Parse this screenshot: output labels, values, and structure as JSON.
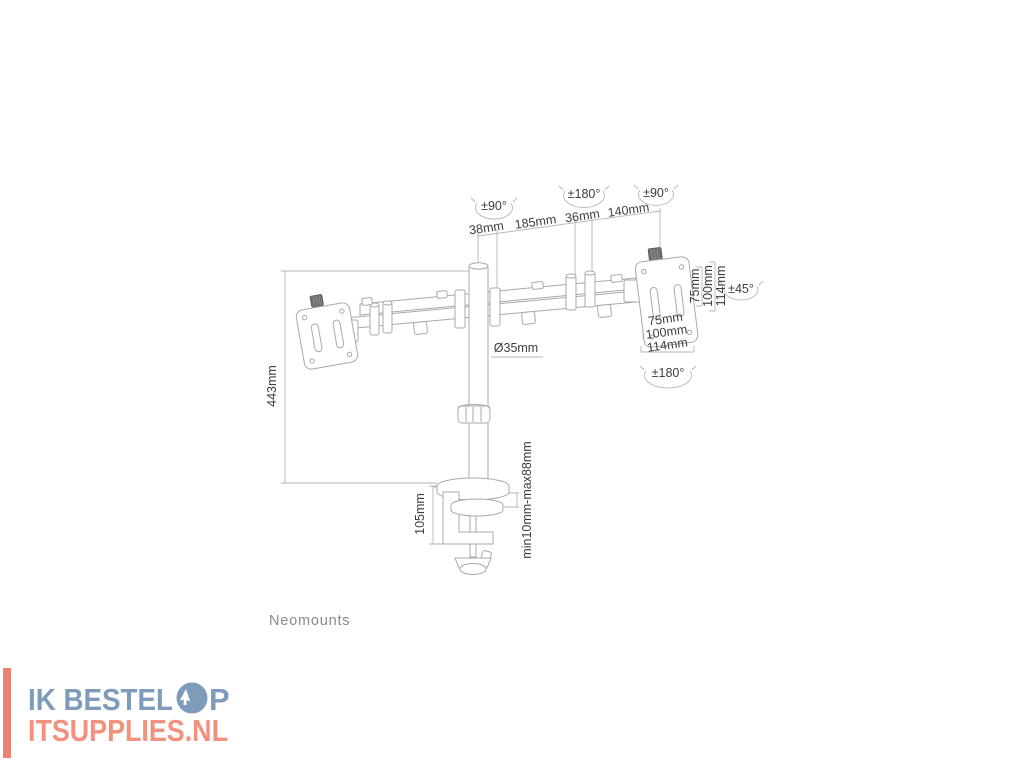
{
  "diagram": {
    "brand_label": "Neomounts",
    "top": {
      "rot_left": "±90°",
      "rot_mid": "±180°",
      "rot_right": "±90°",
      "dim1": "38mm",
      "dim2": "185mm",
      "dim3": "36mm",
      "dim4": "140mm"
    },
    "pole": {
      "height": "443mm",
      "diameter": "Ø35mm"
    },
    "clamp": {
      "height": "105mm",
      "range": "min10mm-max88mm"
    },
    "vesa_right": {
      "v75": "75mm",
      "v100": "100mm",
      "v114": "114mm",
      "h75": "75mm",
      "h100": "100mm",
      "h114": "114mm",
      "tilt": "±45°",
      "swivel": "±180°"
    }
  },
  "watermark": {
    "line1": "IK BESTEL OP",
    "line1_prefix": "IK BESTEL",
    "line1_suffix": "P",
    "line2": "ITSUPPLIES.NL",
    "colors": {
      "blue": "#7e9cba",
      "salmon": "#f2917e",
      "bar": "#ee8271"
    }
  },
  "colors": {
    "drawing_line": "#a9a9a9",
    "dimension_line": "#b6b6b6",
    "label_text": "#3d3d3d",
    "brand_text": "#8a8a8a",
    "background": "#ffffff"
  }
}
